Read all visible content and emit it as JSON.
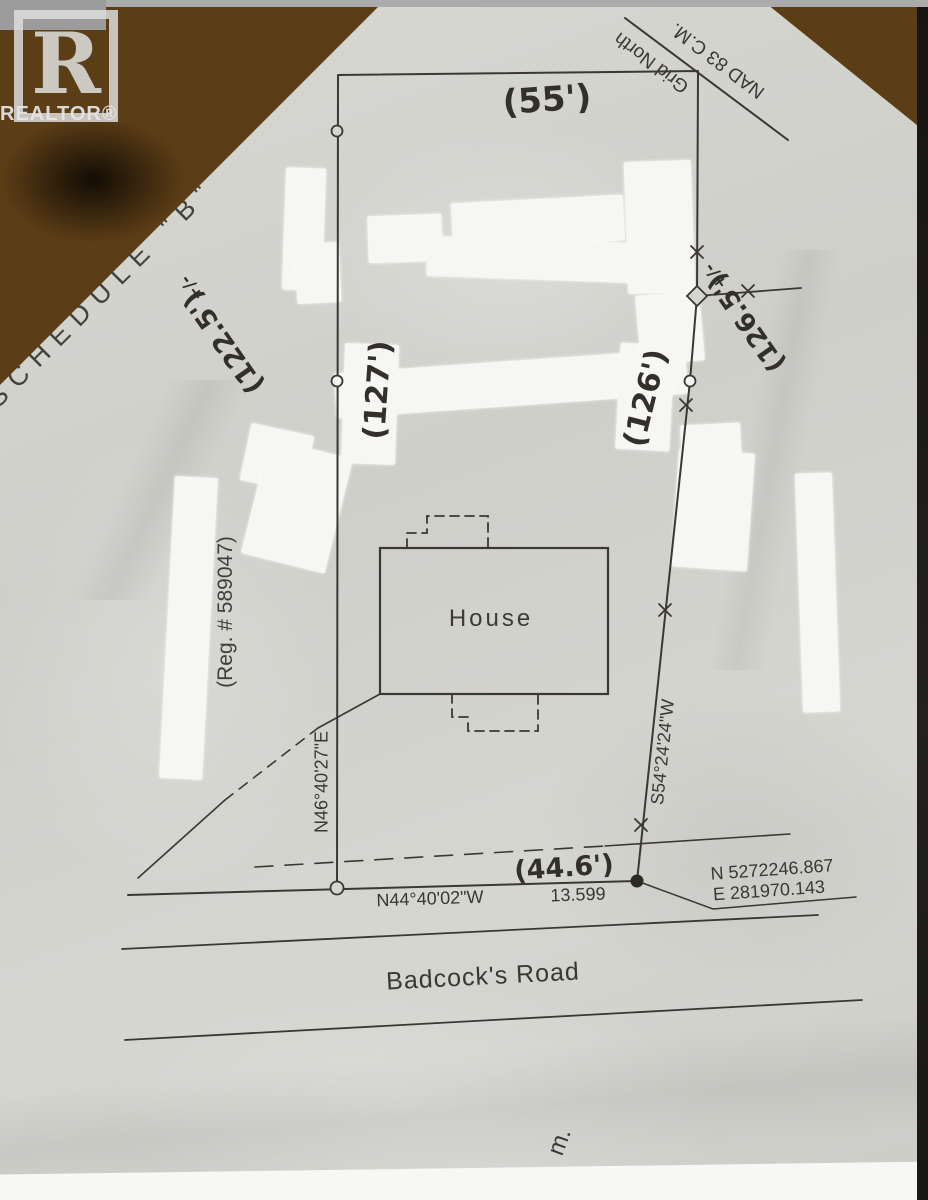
{
  "document": {
    "schedule_label": "SCHEDULE \"B\"",
    "realtor_logo": {
      "letter": "R",
      "word": "REALTOR®"
    },
    "north_arrow": {
      "label": "Grid North",
      "datum": "NAD 83 C.M."
    },
    "registration": "(Reg. # 589047)",
    "house_label": "House",
    "road_name": "Badcock's Road",
    "misc_label": "m.",
    "boundaries": {
      "rear": {
        "handwritten": "(55')"
      },
      "left": {
        "bearing": "N46°40'27\"E",
        "handwritten": "(127')"
      },
      "right": {
        "bearing": "S54°24'24\"W",
        "handwritten": "(126')"
      },
      "front": {
        "bearing": "N44°40'02\"W",
        "distance": "13.599",
        "handwritten": "(44.6')"
      },
      "left_outer_handwritten": "(122.5')",
      "right_outer_handwritten": "(126.5')",
      "plus_minus": "+/-"
    },
    "corner_coordinates": {
      "northing": "N 5272246.867",
      "easting": "E  281970.143"
    },
    "colors": {
      "paper": "#d3d3ce",
      "ink": "#3b3732",
      "whiteout": "#f6f6f2",
      "marble": "#5b3d16"
    }
  }
}
